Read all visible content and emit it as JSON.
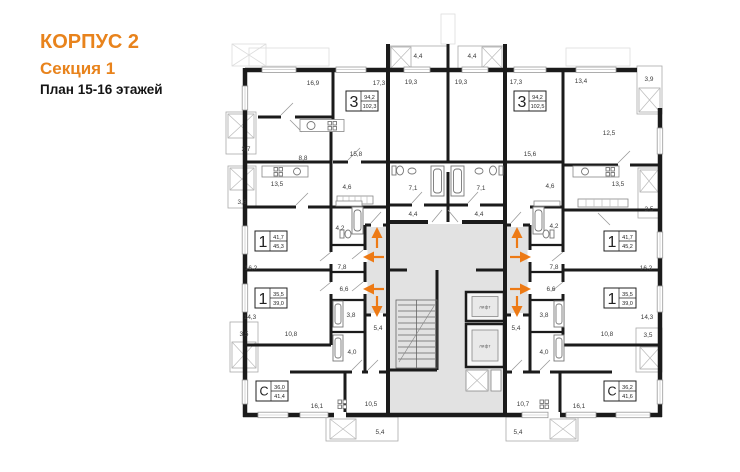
{
  "header": {
    "building": "КОРПУС 2",
    "section": "Секция 1",
    "floors": "План 15-16 этажей"
  },
  "theme": {
    "accent_orange": "#E8831C",
    "arrow_orange": "#ED7A15",
    "wall_black": "#1B1B1B",
    "core_gray": "#E2E2E2"
  },
  "plan": {
    "core": {
      "elevator_label": "лифт"
    },
    "apartments": [
      {
        "type": "3",
        "area_living": "94,2",
        "area_total": "102,3"
      },
      {
        "type": "3",
        "area_living": "94,2",
        "area_total": "102,5"
      },
      {
        "type": "1",
        "area_living": "41,7",
        "area_total": "45,3"
      },
      {
        "type": "1",
        "area_living": "41,7",
        "area_total": "45,2"
      },
      {
        "type": "1",
        "area_living": "35,5",
        "area_total": "39,0"
      },
      {
        "type": "1",
        "area_living": "35,5",
        "area_total": "39,0"
      },
      {
        "type": "С",
        "area_living": "36,0",
        "area_total": "41,4"
      },
      {
        "type": "С",
        "area_living": "36,2",
        "area_total": "41,6"
      }
    ],
    "labels": [
      {
        "t": "16,9"
      },
      {
        "t": "17,3"
      },
      {
        "t": "19,3"
      },
      {
        "t": "19,3"
      },
      {
        "t": "17,3"
      },
      {
        "t": "13,4"
      },
      {
        "t": "3,9"
      },
      {
        "t": "4,4"
      },
      {
        "t": "4,4"
      },
      {
        "t": "12,5"
      },
      {
        "t": "15,8"
      },
      {
        "t": "15,6"
      },
      {
        "t": "8,8"
      },
      {
        "t": "3,7"
      },
      {
        "t": "13,5"
      },
      {
        "t": "13,5"
      },
      {
        "t": "4,6"
      },
      {
        "t": "4,6"
      },
      {
        "t": "3,6"
      },
      {
        "t": "3,5"
      },
      {
        "t": "4,2"
      },
      {
        "t": "4,2"
      },
      {
        "t": "7,1"
      },
      {
        "t": "7,1"
      },
      {
        "t": "4,4"
      },
      {
        "t": "4,4"
      },
      {
        "t": "16,2"
      },
      {
        "t": "16,2"
      },
      {
        "t": "7,8"
      },
      {
        "t": "7,8"
      },
      {
        "t": "6,6"
      },
      {
        "t": "6,6"
      },
      {
        "t": "14,3"
      },
      {
        "t": "14,3"
      },
      {
        "t": "3,5"
      },
      {
        "t": "3,5"
      },
      {
        "t": "10,8"
      },
      {
        "t": "10,8"
      },
      {
        "t": "3,8"
      },
      {
        "t": "3,8"
      },
      {
        "t": "5,4"
      },
      {
        "t": "5,4"
      },
      {
        "t": "4,0"
      },
      {
        "t": "4,0"
      },
      {
        "t": "16,1"
      },
      {
        "t": "16,1"
      },
      {
        "t": "10,5"
      },
      {
        "t": "10,7"
      },
      {
        "t": "5,4"
      },
      {
        "t": "5,4"
      }
    ]
  }
}
